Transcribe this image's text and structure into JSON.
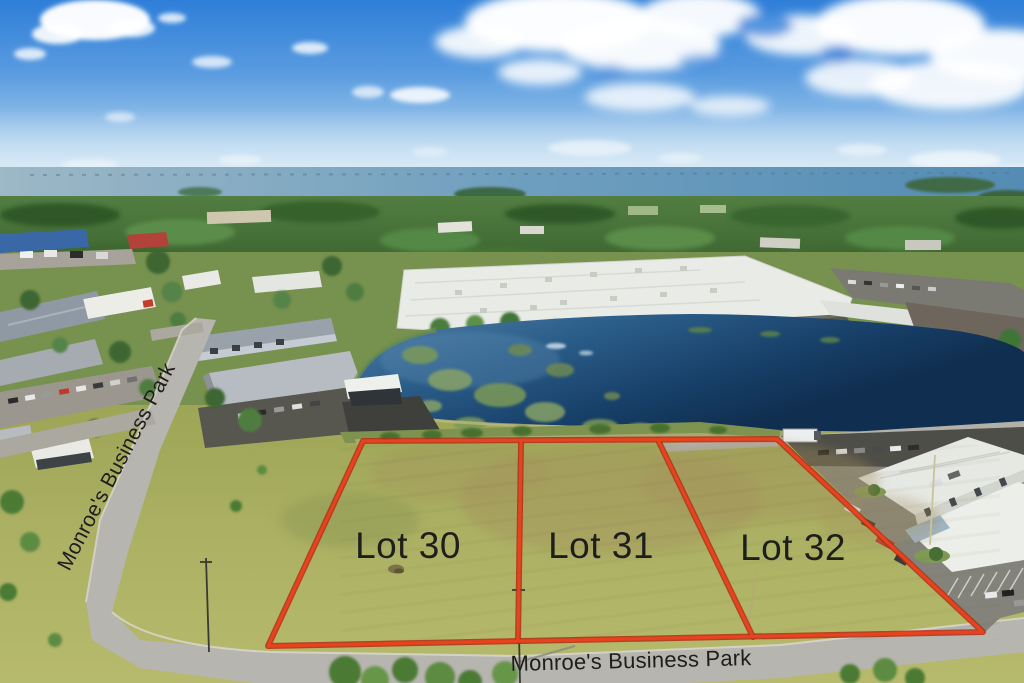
{
  "photo": {
    "name": "Aerial view of Monroe's Business Park with three outlined vacant lots, a pond, warehouses and a bay on the horizon",
    "side_street_label": "Monroe's Business Park",
    "bottom_street_label": "Monroe's Business Park",
    "lot_labels": [
      {
        "label": "Lot 30"
      },
      {
        "label": "Lot 31"
      },
      {
        "label": "Lot 32"
      }
    ],
    "colors": {
      "lot_outline_red": "#e8421f",
      "label_text": "#1e1e1b",
      "sky_blue": "#2e7ed8",
      "pond_blue": "#1c4a77",
      "grass_olive": "#abb063"
    }
  }
}
